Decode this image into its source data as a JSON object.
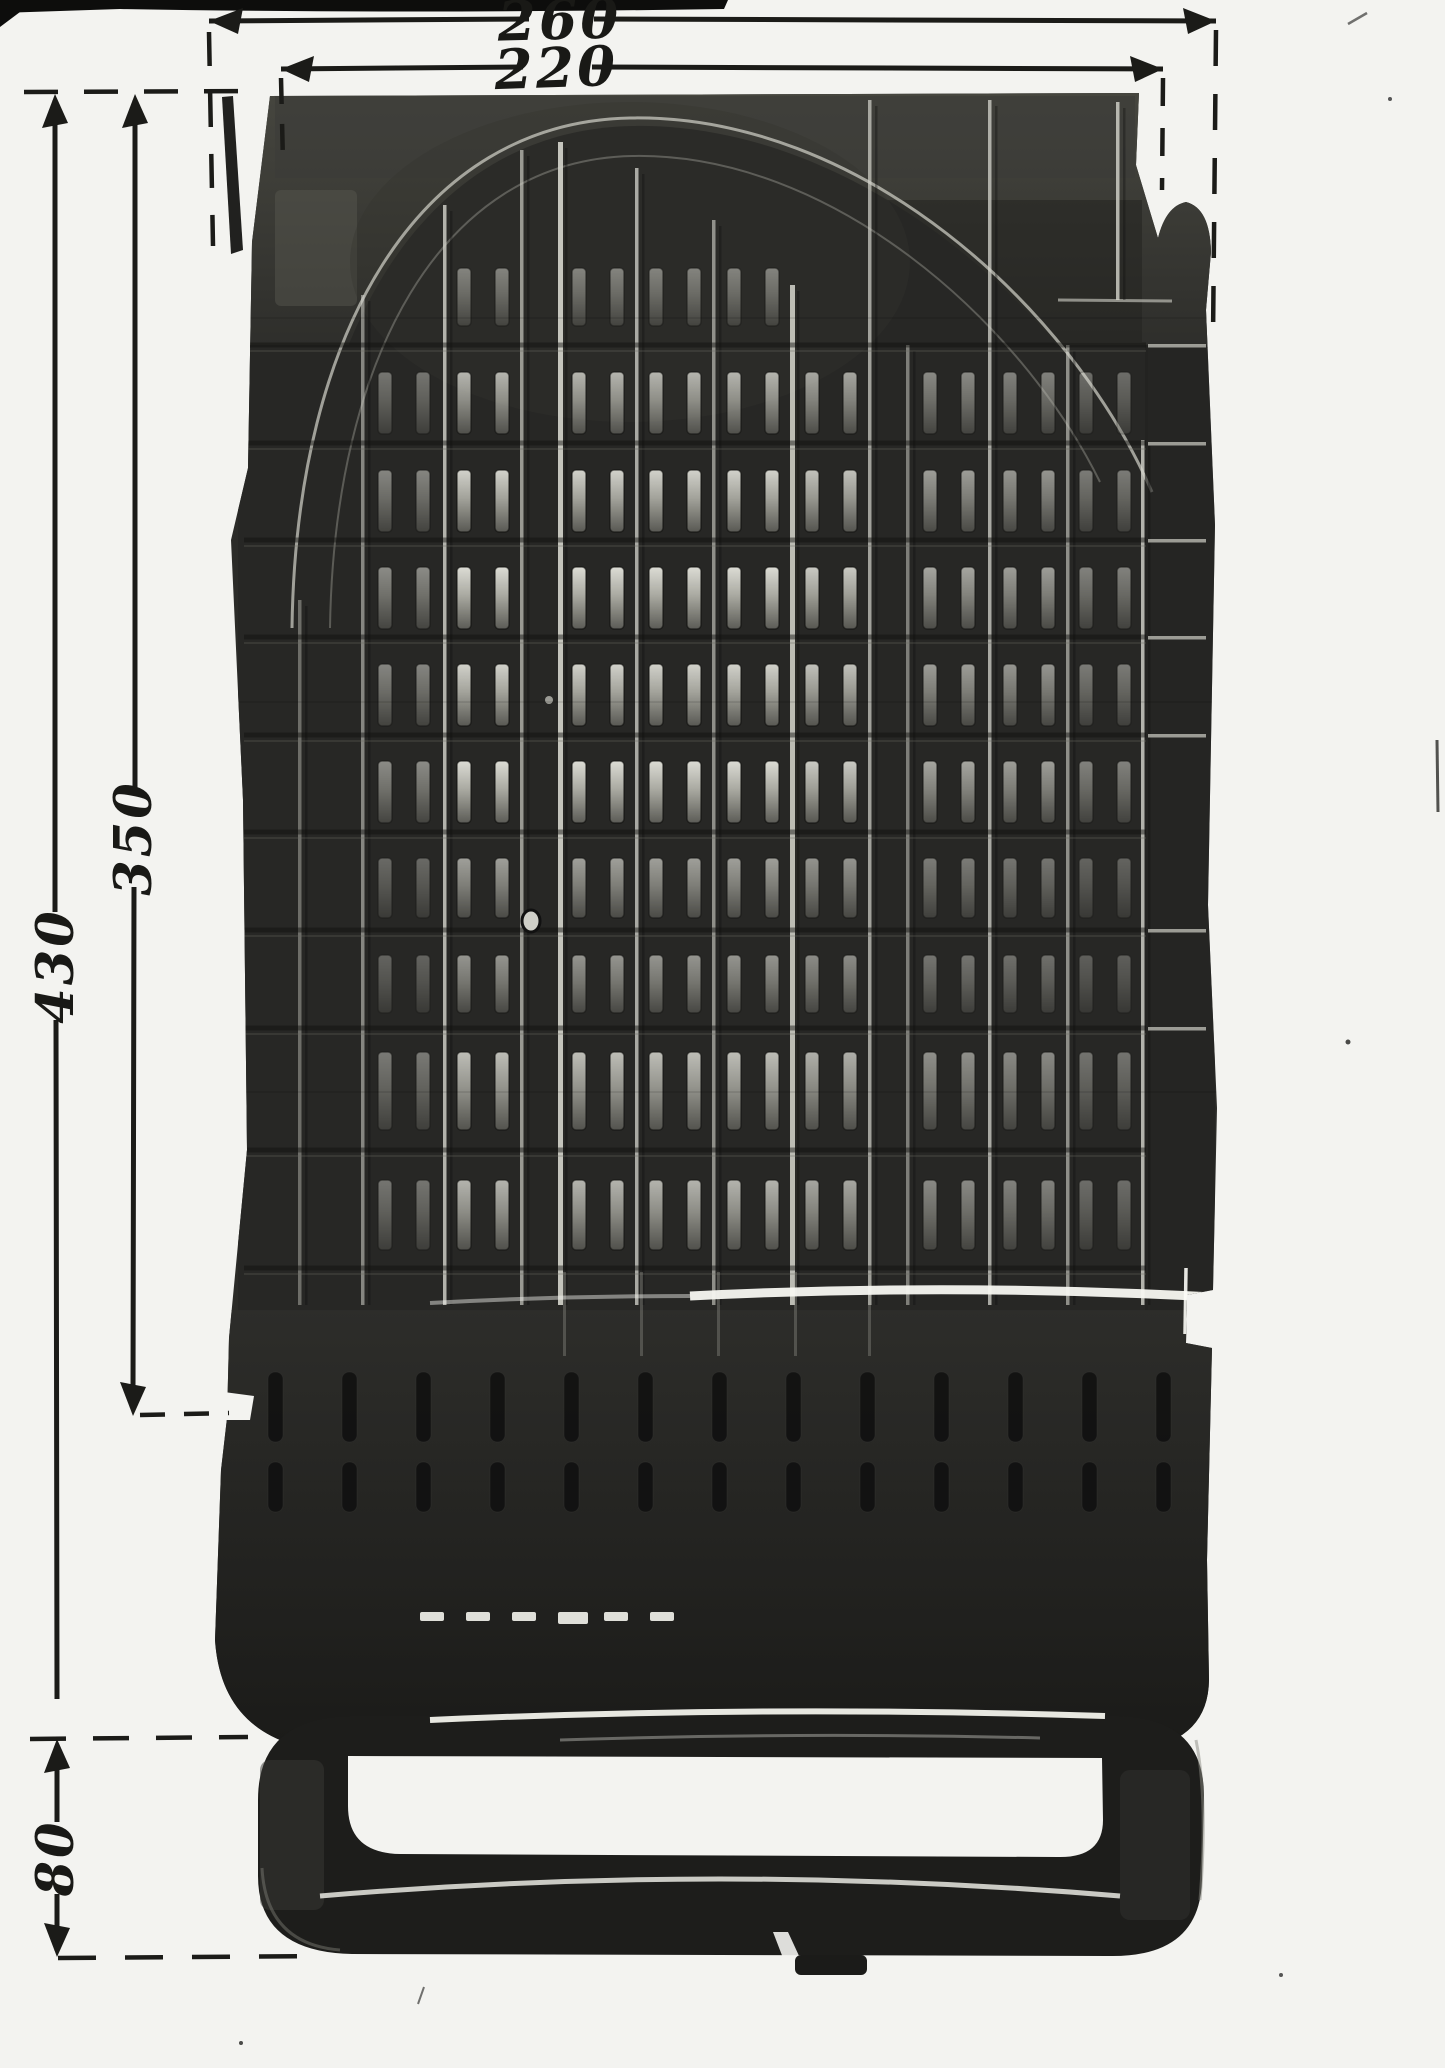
{
  "document": {
    "description": "Black-and-white photograph of a dark molded plastic chair seat shell (slatted pan with foot loop), annotated with handwritten dimension lines"
  },
  "dimensions": {
    "outer_width": {
      "label": "260"
    },
    "top_width": {
      "label": "220"
    },
    "overall_height": {
      "label": "430"
    },
    "body_height": {
      "label": "350"
    },
    "foot_height": {
      "label": "80"
    }
  },
  "figure": {
    "colors": {
      "paper": "#f3f3f0",
      "ink": "#1b1b18",
      "body": "#2b2b28",
      "rib_light": "#d6d6cd",
      "rib_shadow": "#0e0e0d",
      "tick_light": "#c4c4bc",
      "slot_stroke": "#0b0b0a",
      "skirt_slot": "#101010",
      "dash_bright": "#f0f0e9",
      "streak": "#9a9a92"
    },
    "grid": {
      "rib_y2": 1305,
      "ribs": [
        {
          "x": 300,
          "y1": 600,
          "o": 0.4
        },
        {
          "x": 363,
          "y1": 295,
          "o": 0.55
        },
        {
          "x": 445,
          "y1": 205,
          "o": 0.8
        },
        {
          "x": 522,
          "y1": 150,
          "o": 0.65
        },
        {
          "x": 560,
          "y1": 142,
          "o": 0.9
        },
        {
          "x": 637,
          "y1": 168,
          "o": 0.75
        },
        {
          "x": 714,
          "y1": 220,
          "o": 0.6
        },
        {
          "x": 792,
          "y1": 285,
          "o": 0.85
        },
        {
          "x": 870,
          "y1": 100,
          "o": 0.7
        },
        {
          "x": 908,
          "y1": 345,
          "o": 0.5
        },
        {
          "x": 990,
          "y1": 100,
          "o": 0.75
        },
        {
          "x": 1068,
          "y1": 345,
          "o": 0.6
        },
        {
          "x": 1118,
          "y1": 102,
          "y2": 300,
          "o": 0.8
        },
        {
          "x": 1143,
          "y1": 440,
          "o": 0.8
        }
      ],
      "row_lines": [
        345,
        443,
        540,
        637,
        735,
        832,
        930,
        1028,
        1150,
        1268
      ],
      "slot_rows": [
        {
          "y": 268,
          "h": 58,
          "o": 0.45,
          "cells": "arch"
        },
        {
          "y": 372,
          "h": 62,
          "o": 0.7,
          "cells": "all"
        },
        {
          "y": 470,
          "h": 62,
          "o": 0.85,
          "cells": "all"
        },
        {
          "y": 567,
          "h": 62,
          "o": 0.9,
          "cells": "all"
        },
        {
          "y": 664,
          "h": 62,
          "o": 0.85,
          "cells": "all"
        },
        {
          "y": 761,
          "h": 62,
          "o": 0.9,
          "cells": "all"
        },
        {
          "y": 858,
          "h": 60,
          "o": 0.6,
          "cells": "all"
        },
        {
          "y": 955,
          "h": 58,
          "o": 0.55,
          "cells": "all"
        },
        {
          "y": 1052,
          "h": 78,
          "o": 0.75,
          "cells": "all"
        },
        {
          "y": 1180,
          "h": 70,
          "o": 0.7,
          "cells": "all"
        }
      ],
      "cells_all": [
        404,
        483,
        598,
        675,
        753,
        831,
        949,
        1029,
        1105
      ],
      "cells_arch": [
        483,
        598,
        675,
        753
      ],
      "col_factor": {
        "404": 0.55,
        "483": 1,
        "598": 1,
        "675": 1,
        "753": 1,
        "831": 0.9,
        "949": 0.7,
        "1029": 0.65,
        "1105": 0.5
      },
      "slot_dx": 19,
      "slot_w": 14,
      "ticks": {
        "x": 1148,
        "w": 58,
        "h": 3.5,
        "ys": [
          345,
          443,
          540,
          637,
          735,
          930,
          1028
        ]
      }
    },
    "skirt": {
      "slot_rows": [
        {
          "y": 1372,
          "h": 70
        },
        {
          "y": 1462,
          "h": 50
        }
      ],
      "x0": 268,
      "x1": 1190,
      "pitch": 74,
      "w": 15,
      "dashes": {
        "y": 1612,
        "xs": [
          420,
          466,
          512,
          558,
          604,
          650
        ],
        "w": 24,
        "h": 9
      },
      "streaks": {
        "xs": [
          563,
          640,
          717,
          794,
          868
        ],
        "y1": 1272,
        "y2": 1356
      }
    }
  }
}
